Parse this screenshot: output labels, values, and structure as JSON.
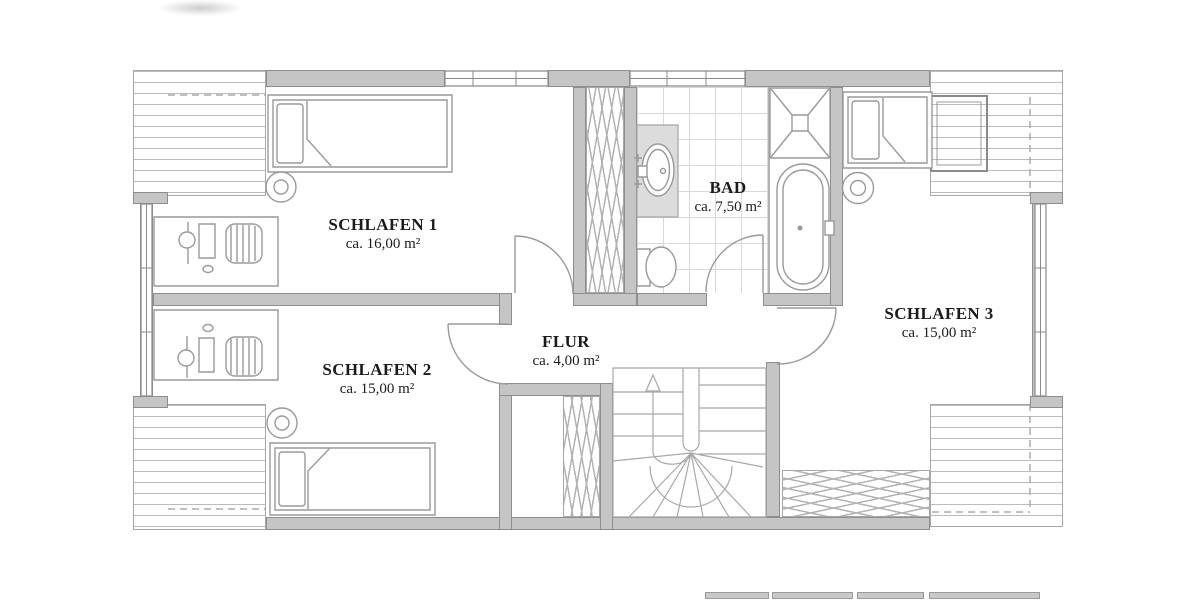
{
  "floor_plan": {
    "rooms": [
      {
        "id": "schlafen-1",
        "name": "SCHLAFEN 1",
        "area": "ca. 16,00 m²"
      },
      {
        "id": "schlafen-2",
        "name": "SCHLAFEN 2",
        "area": "ca. 15,00 m²"
      },
      {
        "id": "schlafen-3",
        "name": "SCHLAFEN 3",
        "area": "ca. 15,00 m²"
      },
      {
        "id": "bad",
        "name": "BAD",
        "area": "ca. 7,50 m²"
      },
      {
        "id": "flur",
        "name": "FLUR",
        "area": "ca. 4,00 m²"
      }
    ],
    "colors": {
      "wall_fill": "#c5c5c5",
      "wall_edge": "#8e8e8e",
      "drawing_line": "#9a9a9a",
      "roof_hatch_line": "#bcbcbc",
      "tile_line": "#d9d9d9",
      "label_text": "#1b1b1b",
      "paper": "#ffffff"
    }
  }
}
